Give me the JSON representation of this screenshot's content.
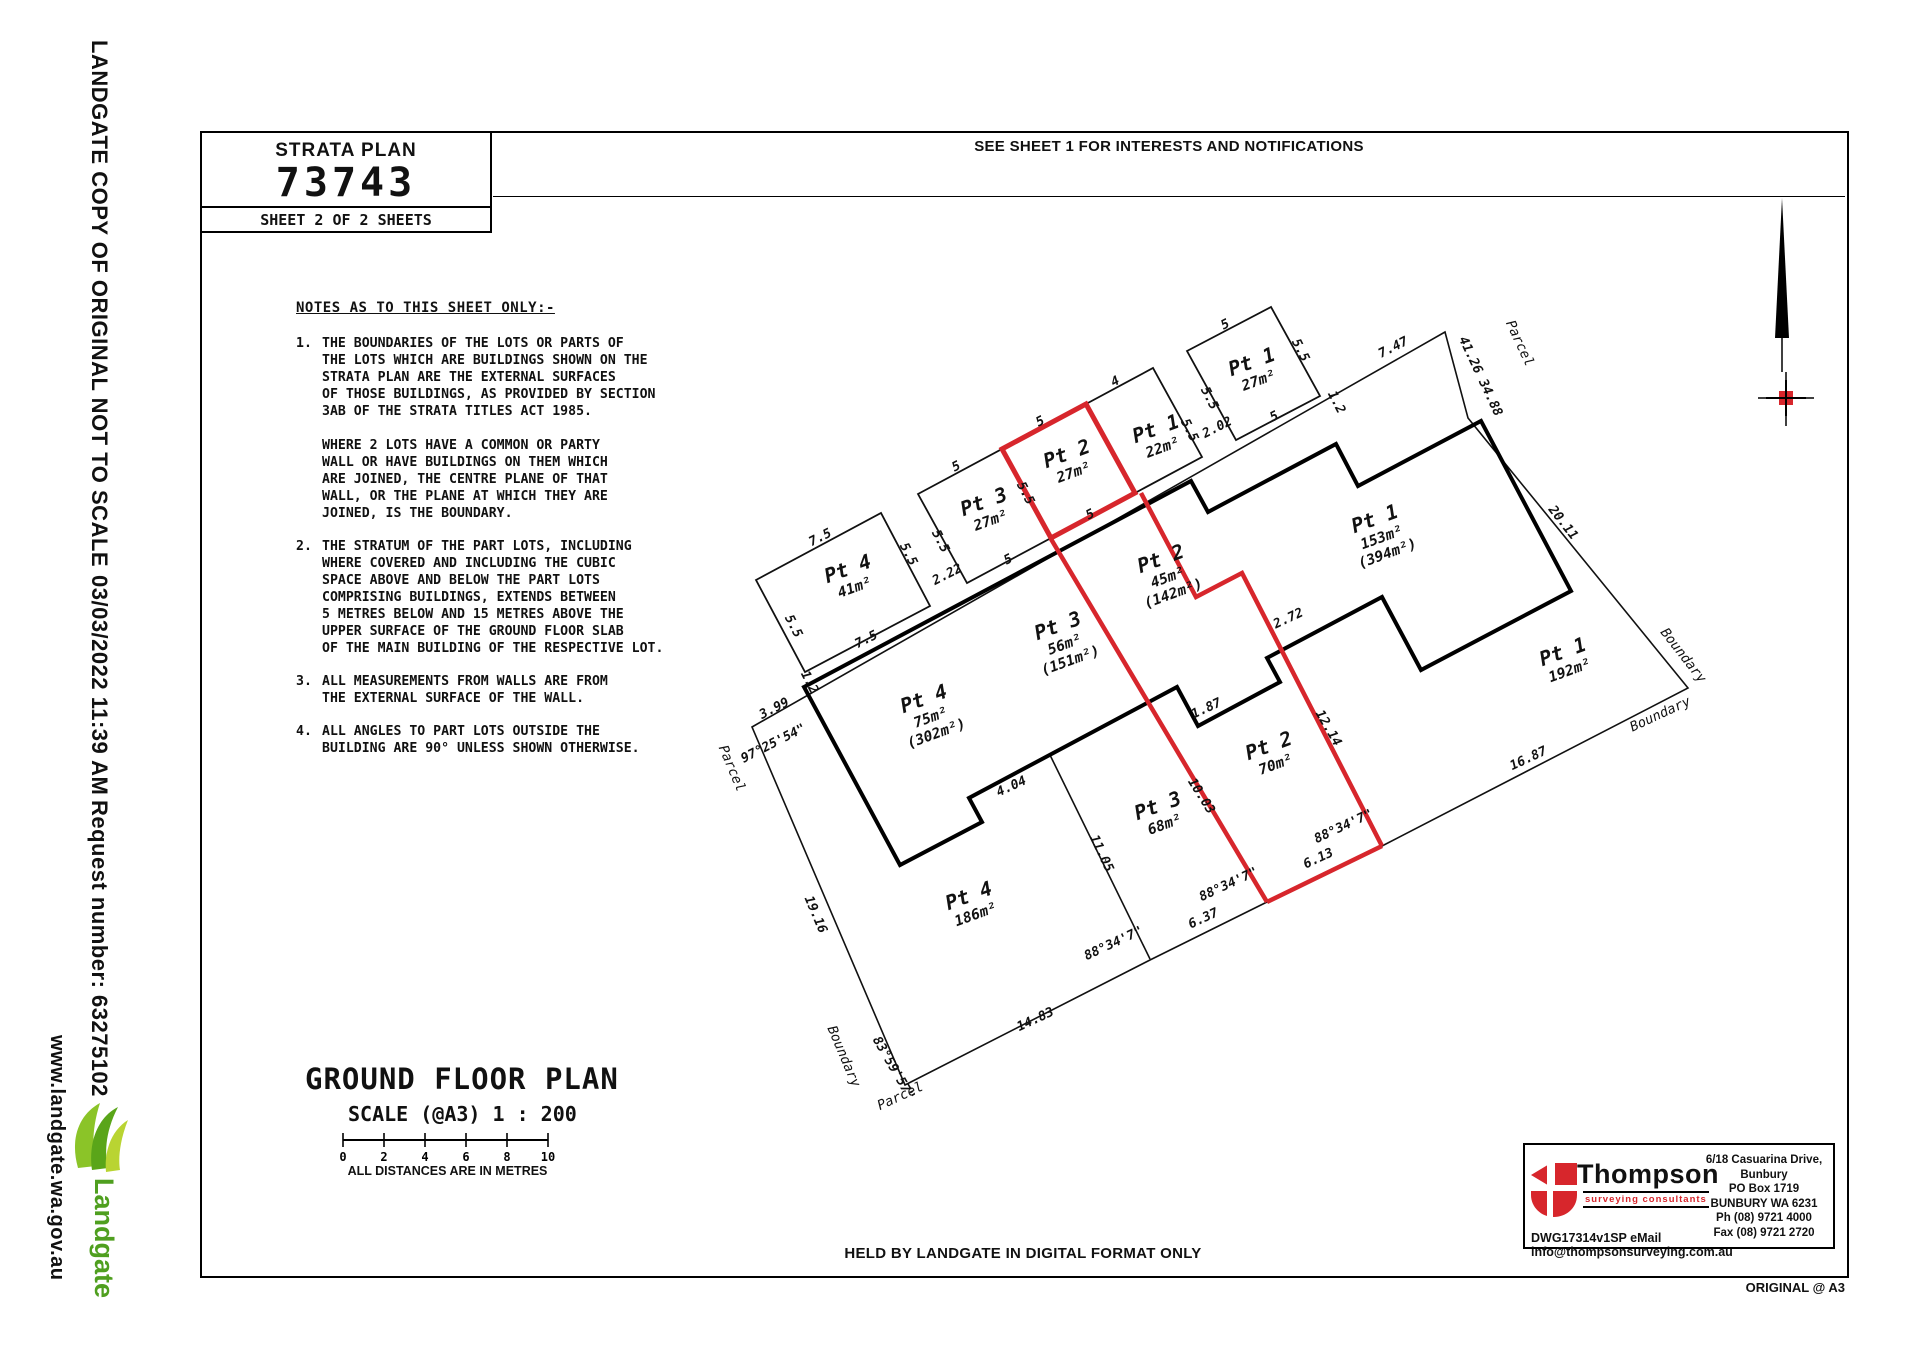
{
  "left_margin": {
    "line1": "LANDGATE COPY OF ORIGINAL NOT TO SCALE",
    "line2": "03/03/2022 11:39 AM",
    "line3": "Request number: 63275102",
    "website": "www.landgate.wa.gov.au",
    "logo_text": "Landgate",
    "logo_green": "#4f9f1f"
  },
  "title_block": {
    "label": "STRATA PLAN",
    "number": "73743",
    "sheet": "SHEET  2  OF  2  SHEETS"
  },
  "top_notice": "SEE SHEET 1 FOR INTERESTS AND NOTIFICATIONS",
  "notes": {
    "heading": "NOTES AS TO THIS SHEET ONLY:-",
    "items": [
      {
        "n": "1.",
        "text": "THE BOUNDARIES OF THE LOTS OR PARTS OF\nTHE LOTS WHICH ARE BUILDINGS SHOWN ON THE\nSTRATA PLAN ARE THE EXTERNAL SURFACES\nOF THOSE BUILDINGS, AS PROVIDED BY SECTION\n3AB OF THE STRATA TITLES ACT 1985.\n\nWHERE 2 LOTS HAVE A COMMON OR PARTY\nWALL OR HAVE BUILDINGS ON THEM WHICH\nARE JOINED, THE CENTRE PLANE OF THAT\nWALL, OR THE PLANE AT WHICH THEY ARE\nJOINED, IS THE BOUNDARY."
      },
      {
        "n": "2.",
        "text": "THE STRATUM OF THE PART LOTS, INCLUDING\nWHERE COVERED AND INCLUDING THE CUBIC\nSPACE ABOVE AND BELOW THE PART LOTS\nCOMPRISING BUILDINGS, EXTENDS BETWEEN\n5 METRES BELOW AND 15 METRES ABOVE THE\nUPPER SURFACE OF THE GROUND FLOOR SLAB\nOF THE MAIN BUILDING OF THE RESPECTIVE LOT."
      },
      {
        "n": "3.",
        "text": "ALL MEASUREMENTS FROM WALLS ARE FROM\nTHE EXTERNAL SURFACE OF THE WALL."
      },
      {
        "n": "4.",
        "text": "ALL ANGLES TO PART LOTS OUTSIDE THE\nBUILDING ARE 90° UNLESS SHOWN OTHERWISE."
      }
    ]
  },
  "plan": {
    "red": "#d7262c",
    "lots": [
      {
        "name": "Pt 4",
        "area": "41m²",
        "x": 850,
        "y": 575,
        "r": -20
      },
      {
        "name": "Pt 3",
        "area": "27m²",
        "x": 986,
        "y": 508,
        "r": -20
      },
      {
        "name": "Pt 2",
        "area": "27m²",
        "x": 1069,
        "y": 460,
        "r": -20
      },
      {
        "name": "Pt 1",
        "area": "22m²",
        "x": 1158,
        "y": 435,
        "r": -20
      },
      {
        "name": "Pt 1",
        "area": "27m²",
        "x": 1254,
        "y": 368,
        "r": -20
      },
      {
        "name": "Pt 2",
        "area": "45m²",
        "area2": "(142m²)",
        "x": 1163,
        "y": 565,
        "r": -20
      },
      {
        "name": "Pt 1",
        "area": "153m²",
        "area2": "(394m²)",
        "x": 1377,
        "y": 525,
        "r": -20
      },
      {
        "name": "Pt 3",
        "area": "56m²",
        "area2": "(151m²)",
        "x": 1060,
        "y": 632,
        "r": -20
      },
      {
        "name": "Pt 4",
        "area": "75m²",
        "area2": "(302m²)",
        "x": 926,
        "y": 705,
        "r": -20
      },
      {
        "name": "Pt 1",
        "area": "192m²",
        "x": 1565,
        "y": 658,
        "r": -20
      },
      {
        "name": "Pt 2",
        "area": "70m²",
        "x": 1271,
        "y": 752,
        "r": -20
      },
      {
        "name": "Pt 3",
        "area": "68m²",
        "x": 1160,
        "y": 812,
        "r": -20
      },
      {
        "name": "Pt 4",
        "area": "186m²",
        "x": 971,
        "y": 902,
        "r": -20
      }
    ],
    "dim_labels": [
      {
        "t": "7.5",
        "x": 822,
        "y": 541,
        "r": -27
      },
      {
        "t": "5.5",
        "x": 790,
        "y": 628,
        "r": 63
      },
      {
        "t": "5.5",
        "x": 905,
        "y": 556,
        "r": 63
      },
      {
        "t": "7.5",
        "x": 868,
        "y": 643,
        "r": -27
      },
      {
        "t": "5",
        "x": 958,
        "y": 470,
        "r": -27
      },
      {
        "t": "5.5",
        "x": 937,
        "y": 543,
        "r": 63
      },
      {
        "t": "5",
        "x": 1010,
        "y": 563,
        "r": -27
      },
      {
        "t": "5",
        "x": 1042,
        "y": 425,
        "r": -27
      },
      {
        "t": "5.5",
        "x": 1022,
        "y": 495,
        "r": 63
      },
      {
        "t": "5",
        "x": 1092,
        "y": 518,
        "r": -27
      },
      {
        "t": "4",
        "x": 1117,
        "y": 385,
        "r": -27
      },
      {
        "t": "5.5",
        "x": 1186,
        "y": 432,
        "r": 63
      },
      {
        "t": "5",
        "x": 1227,
        "y": 328,
        "r": -27
      },
      {
        "t": "5.5",
        "x": 1206,
        "y": 400,
        "r": 63
      },
      {
        "t": "5.5",
        "x": 1297,
        "y": 352,
        "r": 63
      },
      {
        "t": "5",
        "x": 1276,
        "y": 420,
        "r": -27
      },
      {
        "t": "2.22",
        "x": 949,
        "y": 578,
        "r": -27
      },
      {
        "t": "2.02",
        "x": 1219,
        "y": 431,
        "r": -27
      },
      {
        "t": "1.2",
        "x": 806,
        "y": 684,
        "r": 63
      },
      {
        "t": "1.2",
        "x": 1333,
        "y": 404,
        "r": 63
      },
      {
        "t": "3.99",
        "x": 776,
        "y": 712,
        "r": -27
      },
      {
        "t": "7.47",
        "x": 1395,
        "y": 351,
        "r": -27
      },
      {
        "t": "97°25'54\"",
        "x": 775,
        "y": 747,
        "r": -27
      },
      {
        "t": "19.16",
        "x": 812,
        "y": 916,
        "r": 67
      },
      {
        "t": "83°59'57\"",
        "x": 890,
        "y": 1070,
        "r": 60
      },
      {
        "t": "14.83",
        "x": 1037,
        "y": 1023,
        "r": -25
      },
      {
        "t": "6.37",
        "x": 1205,
        "y": 922,
        "r": -25
      },
      {
        "t": "6.13",
        "x": 1320,
        "y": 862,
        "r": -25
      },
      {
        "t": "16.87",
        "x": 1530,
        "y": 762,
        "r": -25
      },
      {
        "t": "88°34'7\"",
        "x": 1115,
        "y": 947,
        "r": -25
      },
      {
        "t": "88°34'7\"",
        "x": 1230,
        "y": 888,
        "r": -25
      },
      {
        "t": "88°34'7\"",
        "x": 1345,
        "y": 830,
        "r": -25
      },
      {
        "t": "20.11",
        "x": 1560,
        "y": 525,
        "r": 52
      },
      {
        "t": "41.26  34.88",
        "x": 1477,
        "y": 378,
        "r": 65
      },
      {
        "t": "11.05",
        "x": 1098,
        "y": 855,
        "r": 65
      },
      {
        "t": "10.03",
        "x": 1198,
        "y": 798,
        "r": 58
      },
      {
        "t": "12.14",
        "x": 1325,
        "y": 730,
        "r": 60
      },
      {
        "t": "2.72",
        "x": 1290,
        "y": 622,
        "r": -25
      },
      {
        "t": "1.87",
        "x": 1208,
        "y": 712,
        "r": -25
      },
      {
        "t": "4.04",
        "x": 1013,
        "y": 790,
        "r": -25
      }
    ],
    "boundary_labels": [
      {
        "t": "Parcel",
        "x": 728,
        "y": 770,
        "r": 67
      },
      {
        "t": "Parcel",
        "x": 902,
        "y": 1100,
        "r": -25
      },
      {
        "t": "Boundary",
        "x": 840,
        "y": 1058,
        "r": 67
      },
      {
        "t": "Parcel",
        "x": 1516,
        "y": 345,
        "r": 65
      },
      {
        "t": "Boundary",
        "x": 1680,
        "y": 658,
        "r": 52
      },
      {
        "t": "Boundary",
        "x": 1662,
        "y": 718,
        "r": -25
      }
    ]
  },
  "ground_floor": {
    "title": "GROUND FLOOR PLAN",
    "scale": "SCALE (@A3)  1 : 200",
    "ticks": [
      "0",
      "2",
      "4",
      "6",
      "8",
      "10"
    ],
    "note": "ALL DISTANCES ARE IN METRES"
  },
  "held_by": "HELD BY LANDGATE IN DIGITAL FORMAT ONLY",
  "thompson": {
    "name": "Thompson",
    "tagline": "surveying consultants",
    "address": [
      "6/18 Casuarina Drive,",
      "Bunbury",
      "PO Box 1719",
      "BUNBURY WA 6231",
      "Ph (08) 9721 4000",
      "Fax (08) 9721 2720"
    ],
    "dwg": "DWG17314v1SP   eMail  info@thompsonsurveying.com.au"
  },
  "original_a3": "ORIGINAL @ A3"
}
